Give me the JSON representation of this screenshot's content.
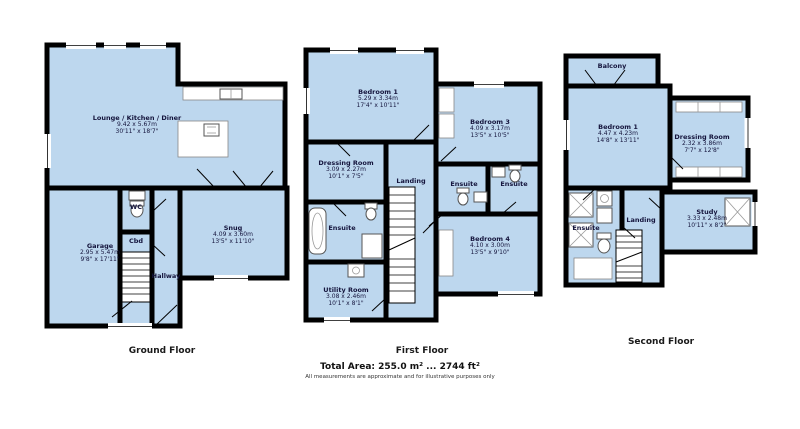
{
  "floors": {
    "ground": {
      "label": "Ground Floor",
      "rooms": {
        "lounge": {
          "name": "Lounge / Kitchen / Diner",
          "metric": "9.42 x 5.67m",
          "imperial": "30'11\" x 18'7\""
        },
        "garage": {
          "name": "Garage",
          "metric": "2.95 x 5.47m",
          "imperial": "9'8\" x 17'11\""
        },
        "wc": {
          "name": "WC"
        },
        "cbd": {
          "name": "Cbd"
        },
        "hallway": {
          "name": "Hallway"
        },
        "snug": {
          "name": "Snug",
          "metric": "4.09 x 3.60m",
          "imperial": "13'5\" x 11'10\""
        }
      }
    },
    "first": {
      "label": "First Floor",
      "rooms": {
        "bedroom1": {
          "name": "Bedroom 1",
          "metric": "5.29 x 3.34m",
          "imperial": "17'4\" x 10'11\""
        },
        "bedroom3": {
          "name": "Bedroom 3",
          "metric": "4.09 x 3.17m",
          "imperial": "13'5\" x 10'5\""
        },
        "dressing": {
          "name": "Dressing Room",
          "metric": "3.09 x 2.27m",
          "imperial": "10'1\" x 7'5\""
        },
        "landing": {
          "name": "Landing"
        },
        "ensuite_left": {
          "name": "Ensuite"
        },
        "ensuite_mid": {
          "name": "Ensuite"
        },
        "ensuite_right": {
          "name": "Ensuite"
        },
        "bedroom4": {
          "name": "Bedroom 4",
          "metric": "4.10 x 3.00m",
          "imperial": "13'5\" x 9'10\""
        },
        "utility": {
          "name": "Utility Room",
          "metric": "3.08 x 2.46m",
          "imperial": "10'1\" x 8'1\""
        }
      }
    },
    "second": {
      "label": "Second Floor",
      "rooms": {
        "balcony": {
          "name": "Balcony"
        },
        "bedroom1": {
          "name": "Bedroom 1",
          "metric": "4.47 x 4.23m",
          "imperial": "14'8\" x 13'11\""
        },
        "dressing": {
          "name": "Dressing Room",
          "metric": "2.32 x 3.86m",
          "imperial": "7'7\" x 12'8\""
        },
        "ensuite": {
          "name": "Ensuite"
        },
        "landing": {
          "name": "Landing"
        },
        "study": {
          "name": "Study",
          "metric": "3.33 x 2.48m",
          "imperial": "10'11\" x 8'2\""
        }
      }
    }
  },
  "footer": {
    "total_area": "Total Area: 255.0 m² ... 2744 ft²",
    "disclaimer": "All measurements are approximate and for illustrative purposes only"
  },
  "colors": {
    "room_fill": "#BDD7EE",
    "wall": "#000000",
    "text": "#14143c"
  }
}
